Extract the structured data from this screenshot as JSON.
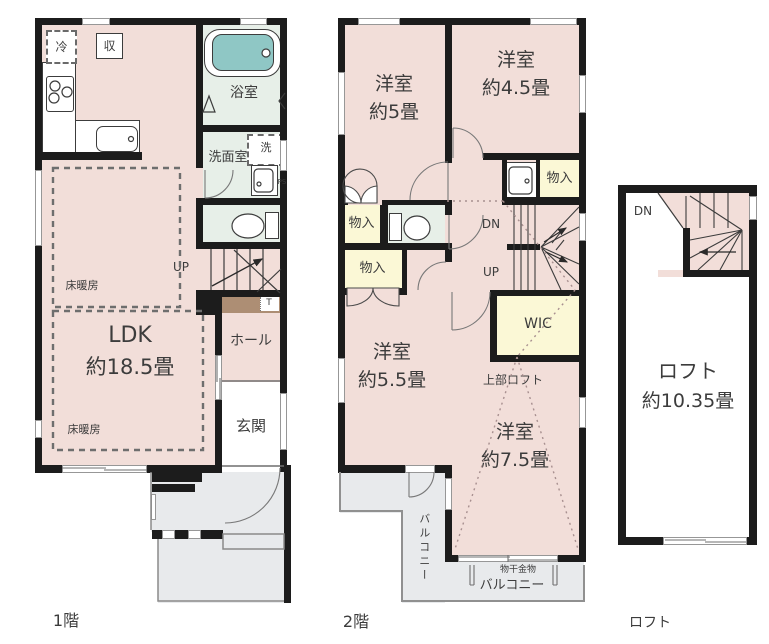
{
  "title": "間取り図",
  "colors": {
    "wall": "#1c1c1c",
    "room_pink": "#f2ded9",
    "wet_area_green": "#e7efe8",
    "closet_yellow": "#fbf8d6",
    "balcony_gray": "#e8eaec",
    "bathtub_teal": "#8fc7c5",
    "shoe_cabinet_brown": "#ad8e74"
  },
  "floor1": {
    "floor_label": "1階",
    "ldk": {
      "name": "LDK",
      "size": "約18.5畳",
      "floor_heating": "床暖房"
    },
    "kitchen": {
      "fridge": "冷",
      "storage": "収"
    },
    "bath": {
      "label": "浴室"
    },
    "washroom": {
      "label": "洗面室",
      "washer": "洗",
      "pipe_space": "PS"
    },
    "hall": {
      "label": "ホール",
      "shoe_cabinet": "T"
    },
    "entrance": {
      "label": "玄関"
    },
    "stairs": {
      "up": "UP"
    }
  },
  "floor2": {
    "floor_label": "2階",
    "room_5": {
      "name": "洋室",
      "size": "約5畳"
    },
    "room_45": {
      "name": "洋室",
      "size": "約4.5畳"
    },
    "room_55": {
      "name": "洋室",
      "size": "約5.5畳"
    },
    "room_75": {
      "name": "洋室",
      "size": "約7.5畳"
    },
    "closet_label": "物入",
    "wic": {
      "label": "WIC"
    },
    "upper_loft": "上部ロフト",
    "stairs": {
      "dn": "DN",
      "up": "UP"
    },
    "balcony": {
      "label": "バルコニー",
      "laundry_hardware": "物干金物"
    }
  },
  "loft": {
    "floor_label": "ロフト",
    "name": "ロフト",
    "size": "約10.35畳",
    "stairs": {
      "dn": "DN"
    }
  }
}
